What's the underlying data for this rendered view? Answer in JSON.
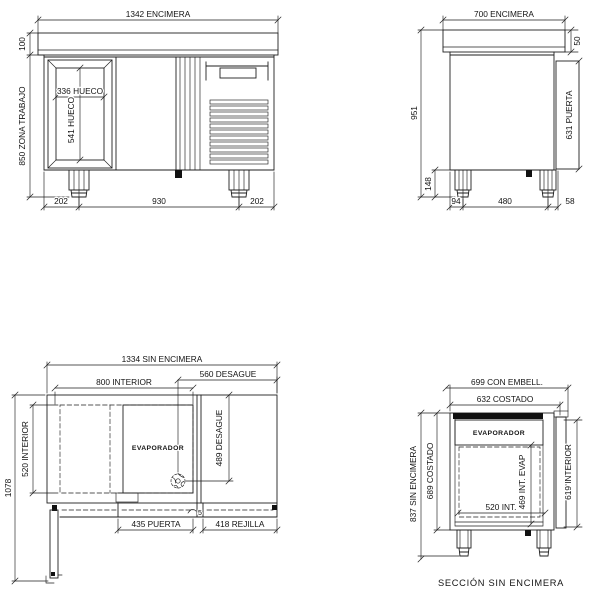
{
  "front_view": {
    "dim_encimera": "1342 ENCIMERA",
    "dim_backsplash": "100",
    "dim_work_zone": "850 ZONA TRABAJO",
    "dim_hueco_width": "336 HUECO",
    "dim_hueco_height": "541 HUECO",
    "dim_bottom_left": "202",
    "dim_bottom_center": "930",
    "dim_bottom_right": "202"
  },
  "side_view": {
    "dim_encimera": "700 ENCIMERA",
    "dim_top_thickness": "50",
    "dim_total_height": "951",
    "dim_door": "631 PUERTA",
    "dim_leg_height": "148",
    "dim_bottom_left": "94",
    "dim_bottom_center": "480",
    "dim_bottom_right": "58"
  },
  "plan_view": {
    "dim_total_width": "1334 SIN ENCIMERA",
    "dim_drain_x": "560 DESAGUE",
    "dim_interior_width": "800 INTERIOR",
    "dim_interior_depth": "520 INTERIOR",
    "dim_total_depth": "1078",
    "evaporator_label": "EVAPORADOR",
    "dim_drain_y": "489 DESAGUE",
    "dim_door": "435 PUERTA",
    "dim_grille": "418 REJILLA",
    "door_note": "5"
  },
  "section_view": {
    "dim_embell": "699 CON EMBELL.",
    "dim_costado_width": "632 COSTADO",
    "evaporator_label": "EVAPORADOR",
    "dim_sin_encimera": "837 SIN ENCIMERA",
    "dim_costado_height": "689 COSTADO",
    "dim_interior_width": "520 INT.",
    "dim_int_evap": "469 INT. EVAP",
    "dim_interior_height": "619 INTERIOR",
    "caption": "SECCIÓN SIN ENCIMERA"
  }
}
